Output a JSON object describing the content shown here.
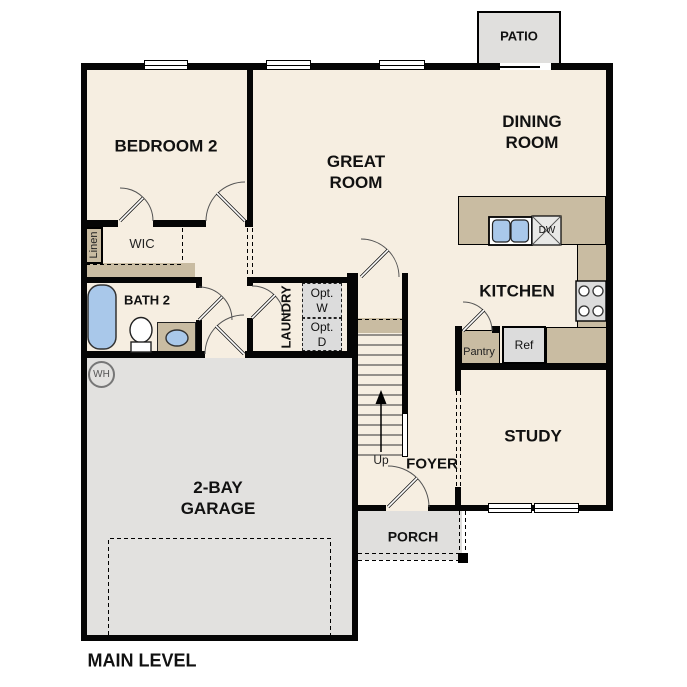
{
  "plan": {
    "title": "MAIN LEVEL",
    "rooms": {
      "patio": "PATIO",
      "bedroom2": "BEDROOM 2",
      "great_room": "GREAT\nROOM",
      "dining_room": "DINING\nROOM",
      "kitchen": "KITCHEN",
      "study": "STUDY",
      "foyer": "FOYER",
      "bath2": "BATH 2",
      "laundry": "LAUNDRY",
      "wic": "WIC",
      "garage": "2-BAY\nGARAGE",
      "porch": "PORCH"
    },
    "features": {
      "linen": "Linen",
      "opt_washer": "Opt.\nW",
      "opt_dryer": "Opt.\nD",
      "dishwasher": "DW",
      "refrigerator": "Ref",
      "pantry": "Pantry",
      "water_heater": "WH",
      "stairs_up": "Up"
    },
    "colors": {
      "floor": "#f6eee1",
      "outdoor": "#e0dfdd",
      "garage": "#e2e1df",
      "counter": "#c9bca2",
      "appliance": "#dcdcdc",
      "fixture": "#a9c8ea",
      "wall": "#050505"
    }
  }
}
